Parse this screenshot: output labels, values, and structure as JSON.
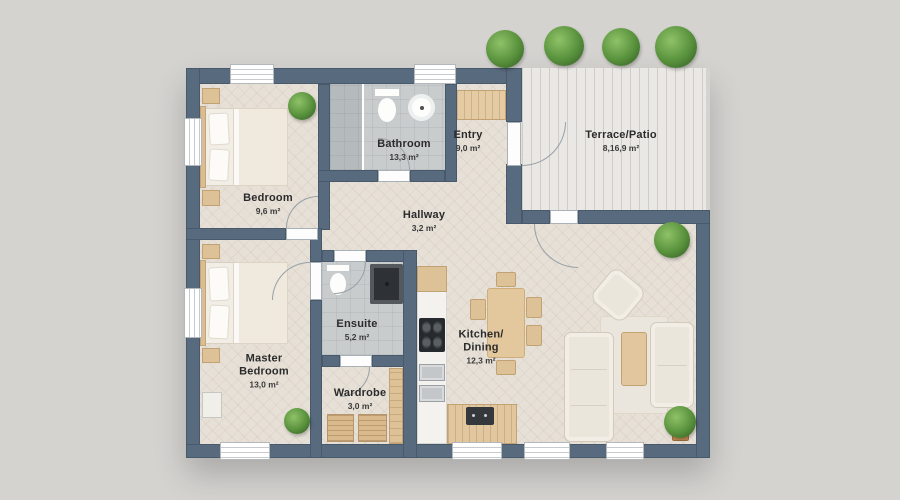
{
  "plan": {
    "title": "Apartment floor plan",
    "rooms": [
      {
        "id": "bedroom",
        "name": "Bedroom",
        "area": "9,6 m²"
      },
      {
        "id": "bathroom",
        "name": "Bathroom",
        "area": "13,3 m²"
      },
      {
        "id": "entry",
        "name": "Entry",
        "area": "9,0 m²"
      },
      {
        "id": "terrace",
        "name": "Terrace/Patio",
        "area": "8,16,9 m²"
      },
      {
        "id": "hallway",
        "name": "Hallway",
        "area": "3,2 m²"
      },
      {
        "id": "master",
        "name": "Master\nBedroom",
        "area": "13,0 m²"
      },
      {
        "id": "ensuite",
        "name": "Ensuite",
        "area": "5,2 m²"
      },
      {
        "id": "wardrobe",
        "name": "Wardrobe",
        "area": "3,0 m²"
      },
      {
        "id": "kitchen",
        "name": "Kitchen/\nDining",
        "area": "12,3 m²"
      }
    ],
    "colors": {
      "background": "#d5d3d0",
      "wall": "#586a7d",
      "floor_wood": "#e6e0d7",
      "tile": "#c9cccd",
      "deck": "#eae8e4",
      "wood_furniture": "#ddc297",
      "sofa": "#ebe6dc",
      "plant": "#58913c",
      "label_text": "#2b2b2b"
    }
  }
}
